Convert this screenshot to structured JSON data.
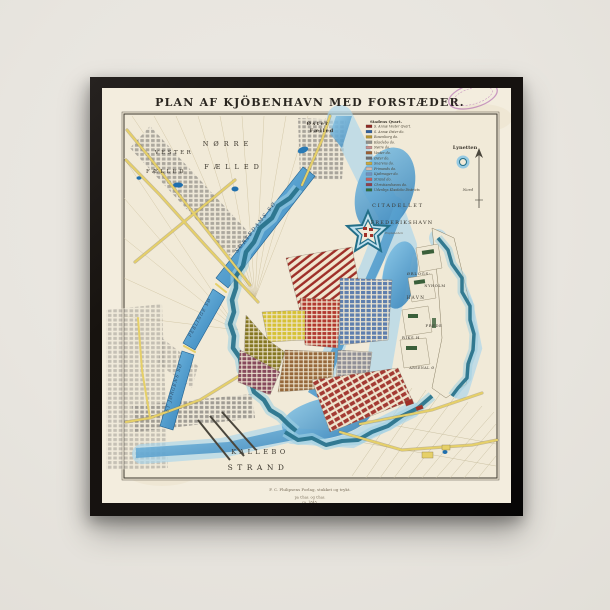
{
  "artwork": {
    "title": "PLAN AF KJÖBENHAVN MED FORSTÆDER.",
    "caption_lines": [
      "F. C. Philipsens Forlag, stukket og trykt.",
      "pa Chas. og Chas.",
      "ca. 1845."
    ]
  },
  "colors": {
    "wall": "#e9e6e0",
    "frame": "#17130f",
    "paper": "#f3edde",
    "ink": "#3a352c",
    "water": "#3f93c8",
    "water_light": "#a9d6ec",
    "moat": "#236f88",
    "road": "#e6d068",
    "quarter_red": "#b23a30",
    "quarter_blue": "#5f7fae",
    "quarter_yellow": "#d6c134",
    "quarter_olive": "#857722",
    "quarter_purple": "#86495c",
    "quarter_brown": "#96683a",
    "quarter_gray": "#8f8f97",
    "nyboder_red": "#9e2f28",
    "holm_green": "#3a5f3a",
    "stamp_purple": "#a855a8"
  },
  "legend": {
    "header": "Stadens Qvart.",
    "items": [
      {
        "color": "#8f2a23",
        "label": "S. Annæ Vester Qvart."
      },
      {
        "color": "#2e5f9e",
        "label": "S. Annæ Øster do."
      },
      {
        "color": "#b5952f",
        "label": "Rosenborg do."
      },
      {
        "color": "#8f8f8a",
        "label": "Klædebo do."
      },
      {
        "color": "#c98f8f",
        "label": "Nørre do."
      },
      {
        "color": "#9a5f33",
        "label": "Vester do."
      },
      {
        "color": "#6f6f6f",
        "label": "Øster do."
      },
      {
        "color": "#c9a93f",
        "label": "Snarens do."
      },
      {
        "color": "#d9b9a9",
        "label": "Frimands do."
      },
      {
        "color": "#6f8fbf",
        "label": "Kjøbmager do."
      },
      {
        "color": "#bf5f5f",
        "label": "Strand do."
      },
      {
        "color": "#8f3f4f",
        "label": "Christianshavns do."
      },
      {
        "color": "#2f6f3f",
        "label": "Udenbys Klædebo Districts"
      }
    ]
  },
  "compass": {
    "label": "Nord"
  },
  "map_labels": [
    {
      "t": "Øster",
      "x": 216,
      "y": 37,
      "s": 5,
      "w": 1,
      "ls": 1.5
    },
    {
      "t": "Fælled",
      "x": 220,
      "y": 44,
      "s": 5,
      "w": 1,
      "ls": 1
    },
    {
      "t": "NØRRE",
      "x": 126,
      "y": 58,
      "s": 6.5,
      "ls": 5
    },
    {
      "t": "FÆLLED",
      "x": 132,
      "y": 81,
      "s": 6.5,
      "ls": 5
    },
    {
      "t": "VESTER",
      "x": 72,
      "y": 66,
      "s": 5.5,
      "ls": 2.5
    },
    {
      "t": "FÆLLED",
      "x": 64,
      "y": 85,
      "s": 5.5,
      "ls": 2.5
    },
    {
      "t": "SORTEDAMS SØ",
      "x": 155,
      "y": 140,
      "s": 5.2,
      "r": -52,
      "ls": 1.5,
      "c": "#2c4a66",
      "i": 1
    },
    {
      "t": "PEBLINGE SØ",
      "x": 99,
      "y": 230,
      "s": 4.4,
      "r": -62,
      "ls": 1,
      "c": "#2c4a66",
      "i": 1
    },
    {
      "t": "ST JØRGENS SØ",
      "x": 73,
      "y": 300,
      "s": 4.4,
      "r": -74,
      "ls": 1,
      "c": "#2c4a66",
      "i": 1
    },
    {
      "t": "CITADELLET",
      "x": 296,
      "y": 119,
      "s": 5,
      "ls": 1.8
    },
    {
      "t": "FREDERIKSHAVN",
      "x": 300,
      "y": 136,
      "s": 5,
      "ls": 1.2
    },
    {
      "t": "Esplanaden",
      "x": 292,
      "y": 146,
      "s": 3,
      "i": 1,
      "c": "#6b6254"
    },
    {
      "t": "ØRLOGS-",
      "x": 317,
      "y": 187,
      "s": 3.8,
      "ls": 0.8
    },
    {
      "t": "NYHOLM",
      "x": 333,
      "y": 199,
      "s": 3.6,
      "ls": 0.6
    },
    {
      "t": "HAVN",
      "x": 314,
      "y": 211,
      "s": 4.2,
      "ls": 1.4
    },
    {
      "t": "FREDE",
      "x": 332,
      "y": 239,
      "s": 3.8,
      "ls": 0.6
    },
    {
      "t": "RIKS H",
      "x": 309,
      "y": 251,
      "s": 3.8,
      "ls": 0.6
    },
    {
      "t": "ARSENAL Ø",
      "x": 320,
      "y": 281,
      "s": 3.3,
      "ls": 0.5
    },
    {
      "t": "Lynetten",
      "x": 363,
      "y": 61,
      "s": 5,
      "w": 1
    },
    {
      "t": "KALLEBO",
      "x": 158,
      "y": 366,
      "s": 6.5,
      "ls": 3.5
    },
    {
      "t": "STRAND",
      "x": 156,
      "y": 382,
      "s": 7.5,
      "ls": 4.5
    }
  ]
}
